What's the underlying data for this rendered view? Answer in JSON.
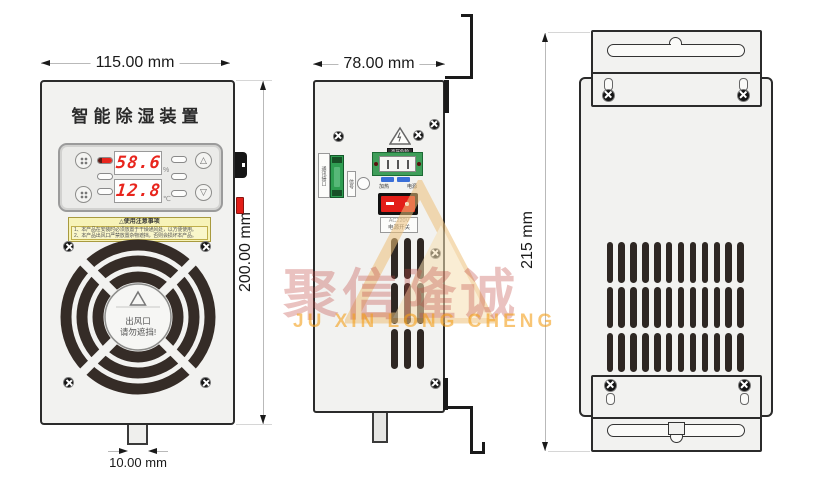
{
  "watermark": {
    "brand_cn": "聚信隆诚",
    "brand_en": "JU XIN LONG CHENG"
  },
  "dimensions": {
    "front_width": "115.00 mm",
    "front_height": "200.00 mm",
    "side_width": "78.00 mm",
    "back_height": "215 mm",
    "tab_width": "10.00 mm"
  },
  "front_view": {
    "title": "智能除湿装置",
    "display": {
      "humidity_value": "58.6",
      "humidity_unit": "%",
      "temperature_value": "12.8",
      "temperature_unit": "℃",
      "up_glyph": "△",
      "down_glyph": "▽"
    },
    "caution_label": {
      "glyph": "△",
      "title": "使用注意事项",
      "line1": "1、本产品在安装时必须放置于干燥通风处，以方便使用。",
      "line2": "2、本产品出风口严禁放置杂物遮挡，否则会损坏本产品。"
    },
    "fan_label": {
      "line1": "出风口",
      "line2": "请勿遮挡!"
    }
  },
  "side_view": {
    "hv_label": "高压危险",
    "comm_label": "通讯接口",
    "signal_label": "信号",
    "terminal_left": "加热",
    "terminal_right": "电源",
    "switch_voltage": "AC220V",
    "switch_name": "电源开关"
  },
  "colors": {
    "display_red": "#e8251d",
    "switch_red": "#e31e18",
    "pcb_green": "#3f9e5a",
    "terminal_green": "#2f9e52",
    "strip_blue": "#3a6fd8",
    "label_yellow": "#f7f3b8",
    "vent_dark": "#2e2723",
    "watermark_red": "#c05050",
    "watermark_orange": "#f39c12"
  }
}
